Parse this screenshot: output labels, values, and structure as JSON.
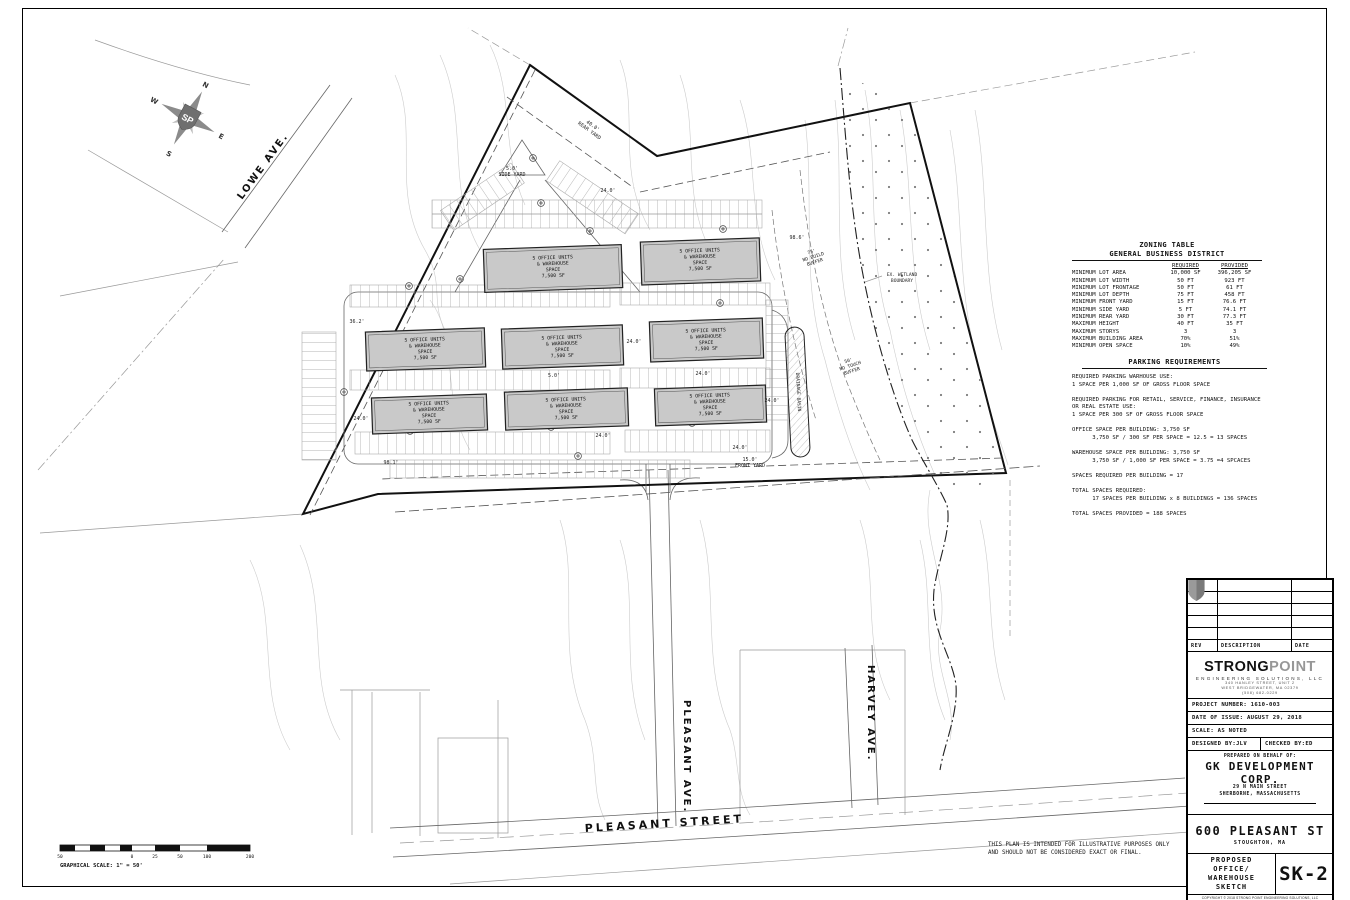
{
  "plan": {
    "compass": {
      "n": "N",
      "e": "E",
      "s": "S",
      "w": "W",
      "monogram": "SP"
    },
    "streets": {
      "lowe": "LOWE AVE.",
      "pleasant_street": "PLEASANT STREET",
      "pleasant_ave": "PLEASANT AVE.",
      "harvey": "HARVEY AVE."
    },
    "building_label": {
      "l1": "5 OFFICE UNITS",
      "l2": "& WAREHOUSE",
      "l3": "SPACE",
      "l4": "7,500 SF"
    },
    "dims": {
      "aisle": "24.0'",
      "rear1": "40.0'",
      "rear2": "REAR YARD",
      "side1": "5.0'",
      "side2": "SIDE YARD",
      "front1": "15.0'",
      "front2": "FRONT YARD",
      "w362": "36.2'",
      "w981": "98.1'",
      "w986": "98.6'",
      "g5": "5.0'"
    },
    "buffers": {
      "nb1": "75'",
      "nb2": "NO BUILD",
      "nb3": "BUFFER",
      "wl1": "EX. WETLAND",
      "wl2": "BOUNDARY",
      "nt1": "50'",
      "nt2": "NO TOUCH",
      "nt3": "BUFFER",
      "drain": "DRAINAGE BASIN"
    }
  },
  "zoning": {
    "title": "ZONING TABLE",
    "subtitle": "GENERAL BUSINESS DISTRICT",
    "col_required": "REQUIRED",
    "col_provided": "PROVIDED",
    "rows": [
      {
        "item": "MINIMUM LOT AREA",
        "req": "10,000 SF",
        "prov": "396,205 SF"
      },
      {
        "item": "MINIMUM LOT WIDTH",
        "req": "50 FT",
        "prov": "923 FT"
      },
      {
        "item": "MINIMUM LOT FRONTAGE",
        "req": "50 FT",
        "prov": "61 FT"
      },
      {
        "item": "MINIMUM LOT DEPTH",
        "req": "75 FT",
        "prov": "458 FT"
      },
      {
        "item": "MINIMUM FRONT YARD",
        "req": "15 FT",
        "prov": "76.6 FT"
      },
      {
        "item": "MINIMUM SIDE YARD",
        "req": "5 FT",
        "prov": "74.1 FT"
      },
      {
        "item": "MINIMUM REAR YARD",
        "req": "30 FT",
        "prov": "77.3 FT"
      },
      {
        "item": "MAXIMUM HEIGHT",
        "req": "40 FT",
        "prov": "35 FT"
      },
      {
        "item": "MAXIMUM STORYS",
        "req": "3",
        "prov": "3"
      },
      {
        "item": "MAXIMUM BUILDING AREA",
        "req": "70%",
        "prov": "51%"
      },
      {
        "item": "MINIMUM OPEN SPACE",
        "req": "10%",
        "prov": "49%"
      }
    ]
  },
  "parking": {
    "title": "PARKING REQUIREMENTS",
    "lines": [
      "REQUIRED PARKING WARHOUSE USE:",
      "1 SPACE PER 1,000 SF OF GROSS FLOOR SPACE",
      "",
      "REQUIRED PARKING FOR RETAIL, SERVICE, FINANCE, INSURANCE",
      "OR REAL ESTATE USE:",
      "1 SPACE PER 300 SF OF GROSS FLOOR SPACE",
      "",
      "OFFICE SPACE PER BUILDING: 3,750 SF",
      "      3,750 SF / 300 SF PER SPACE = 12.5 = 13 SPACES",
      "",
      "WAREHOUSE SPACE PER BUILDING: 3,750 SF",
      "      3,750 SF / 1,000 SF PER SPACE = 3.75 =4 SPCACES",
      "",
      "SPACES REQUIRED PER BUILDING = 17",
      "",
      "TOTAL SPACES REQUIRED:",
      "      17 SPACES PER BUILDING x 8 BUILDINGS = 136 SPACES",
      "",
      "TOTAL SPACES PROVIDED = 188 SPACES"
    ]
  },
  "scalebar": {
    "labels": [
      "50",
      "0",
      "25",
      "50",
      "100",
      "200"
    ],
    "caption": "GRAPHICAL SCALE: 1\" = 50'"
  },
  "disclaimer": {
    "line1": "THIS PLAN IS INTENDED FOR ILLUSTRATIVE PURPOSES ONLY",
    "line2": "AND SHOULD NOT BE CONSIDERED EXACT OR FINAL."
  },
  "titleblock": {
    "rev": {
      "col_rev": "REV",
      "col_desc": "DESCRIPTION",
      "col_date": "DATE"
    },
    "logo": {
      "strong": "STRONG",
      "point": "POINT",
      "sub": "ENGINEERING SOLUTIONS, LLC",
      "addr1": "340 HANLEY STREET, UNIT 2",
      "addr2": "WEST BRIDGEWATER, MA  02379",
      "phone": "(508) 682-0229"
    },
    "project_number": "PROJECT NUMBER: 1610-003",
    "date_of_issue": "DATE OF ISSUE: AUGUST 29, 2018",
    "scale": "SCALE: AS NOTED",
    "designed_by": "DESIGNED BY:JLV",
    "checked_by": "CHECKED BY:ED",
    "prepared": "PREPARED ON BEHALF OF:",
    "client1": "GK DEVELOPMENT",
    "client2": "CORP.",
    "client3": "29 N MAIN STREET",
    "client4": "SHERBORNE, MASSACHUSETTS",
    "addr_big": "600 PLEASANT ST",
    "addr_small": "STOUGHTON, MA",
    "sheet_title1": "PROPOSED",
    "sheet_title2": "OFFICE/",
    "sheet_title3": "WAREHOUSE",
    "sheet_title4": "SKETCH",
    "sheet_no": "SK-2",
    "copyright": "COPYRIGHT © 2018 STRONG POINT ENGINEERING SOLUTIONS, LLC"
  },
  "colors": {
    "building_fill": "#c9c9c9",
    "line": "#111111",
    "contour": "#cccccc"
  }
}
